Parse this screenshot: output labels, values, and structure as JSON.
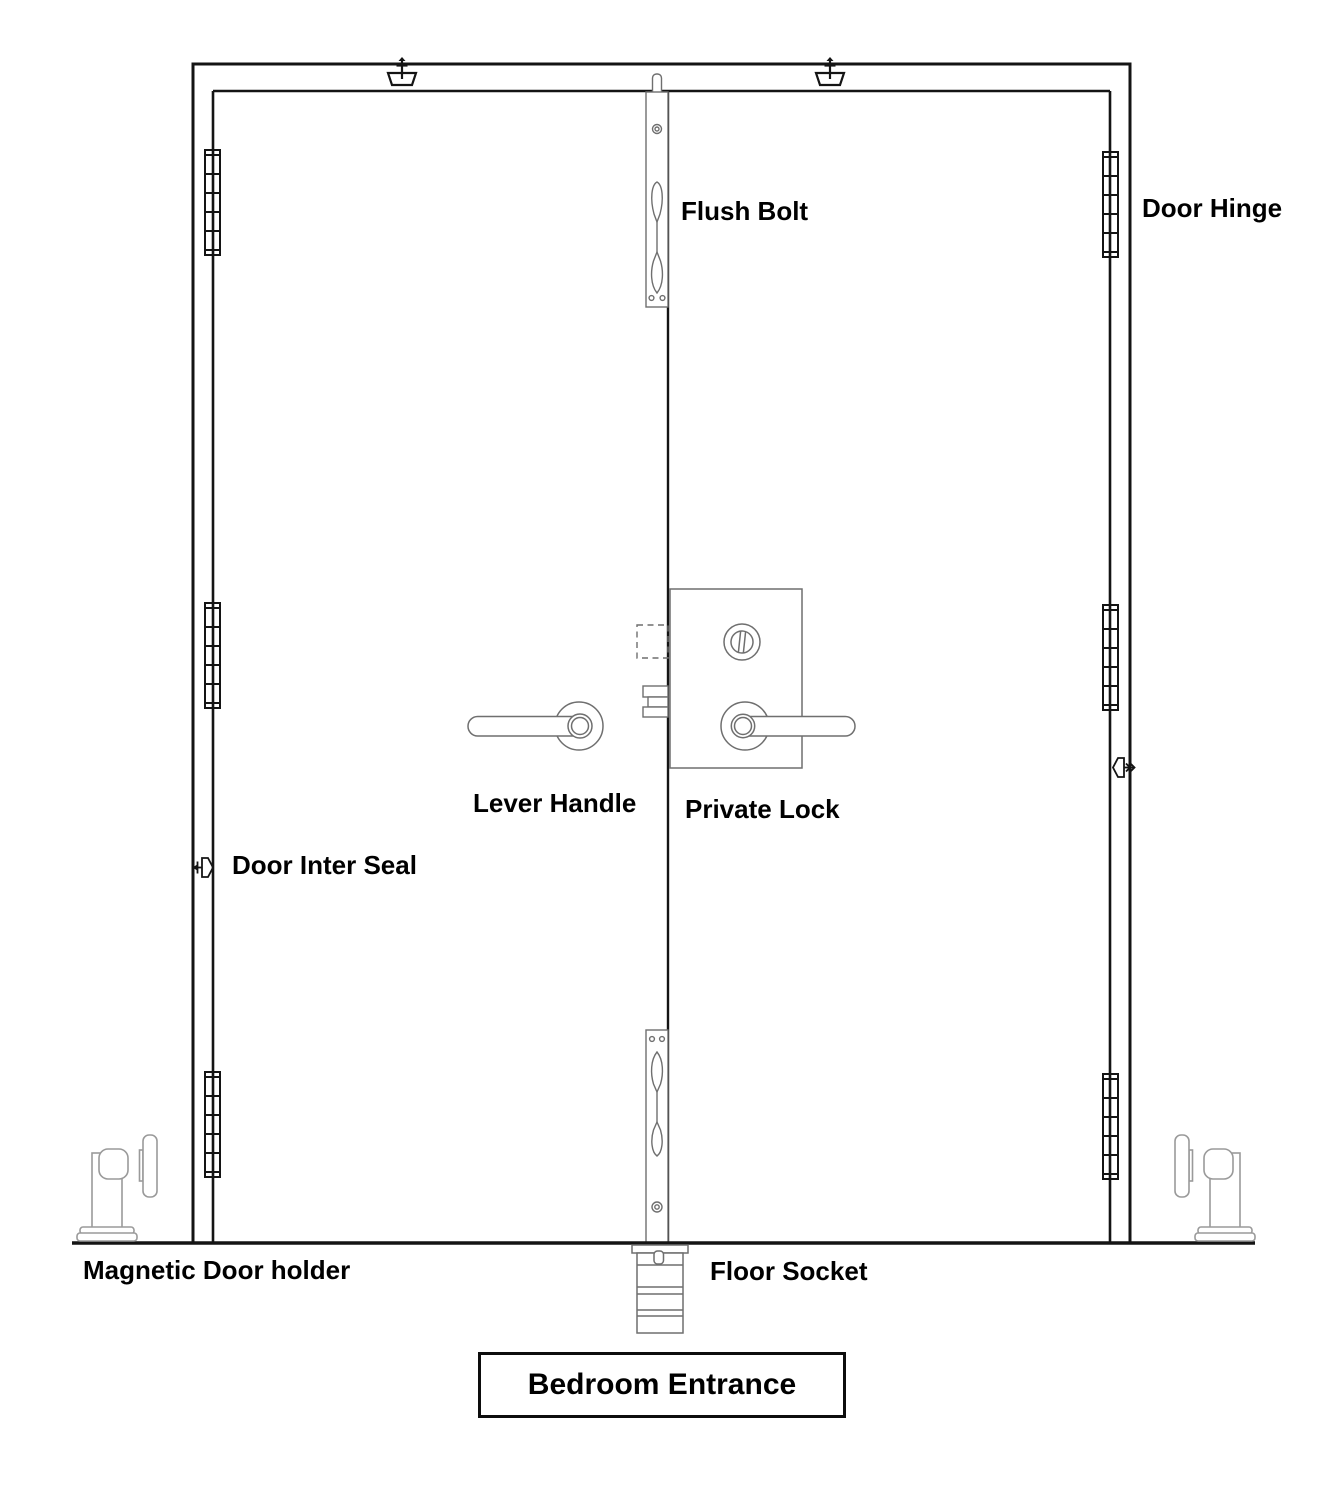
{
  "diagram": {
    "title": "Bedroom Entrance",
    "labels": {
      "flush_bolt": "Flush Bolt",
      "door_hinge": "Door Hinge",
      "lever_handle": "Lever Handle",
      "private_lock": "Private Lock",
      "door_inter_seal": "Door Inter Seal",
      "magnetic_door_holder": "Magnetic Door holder",
      "floor_socket": "Floor Socket",
      "bedroom_entrance": "Bedroom Entrance"
    },
    "icons": {
      "door_closer_icon": "anchor-style top frame fitting symbol",
      "door_inter_seal_left_icon": "left arrow + right-pointing pentagon on left jamb",
      "door_inter_seal_right_icon": "left-pointing pentagon + right arrow on right jamb",
      "hinge_icon": "segmented vertical hinge barrel",
      "flush_bolt_icon": "vertical slide bolt plate with lever",
      "magnetic_holder_icon": "floor post with catch plate",
      "floor_socket_icon": "recessed floor sleeve"
    },
    "colors": {
      "structure_line": "#141414",
      "hardware_line": "#6f6f6f",
      "hardware_light_line": "#9a9a9a",
      "text": "#000000",
      "background": "#ffffff"
    }
  }
}
